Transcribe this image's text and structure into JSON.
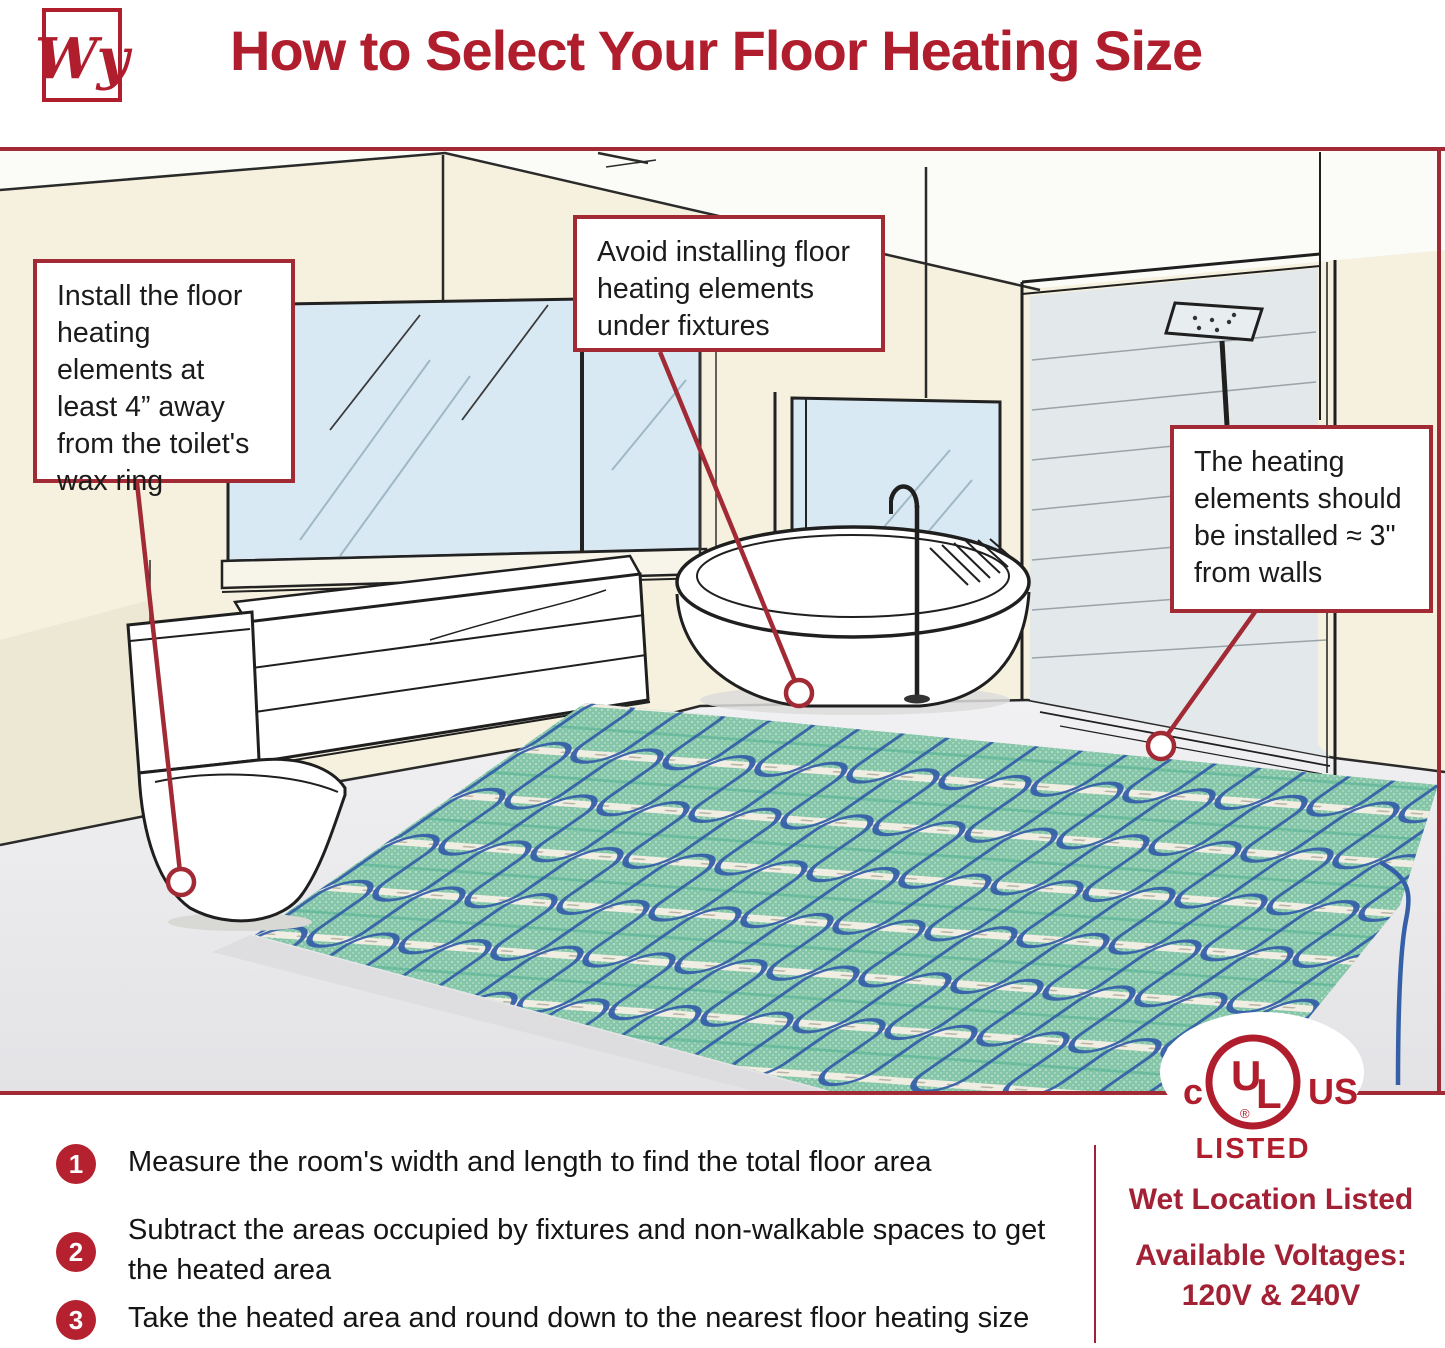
{
  "page": {
    "width": 1445,
    "height": 1348
  },
  "colors": {
    "brand_red": "#B01E2E",
    "accent_red": "#A22A35",
    "step_circle_red": "#B5212E",
    "text_black": "#1B1B1B",
    "wall_beige": "#F5F1DE",
    "window_blue": "#D9E9F3",
    "floor_gray": "#EAEAEC",
    "mat_green": "#85C5A8",
    "cable_blue": "#3560A8"
  },
  "header": {
    "logo_text": "Wy",
    "title": "How to Select Your Floor Heating Size"
  },
  "callouts": {
    "toilet": "Install the floor heating elements at least 4” away from the toilet's wax ring",
    "fixtures": "Avoid installing floor heating elements under fixtures",
    "walls": "The heating elements should be installed ≈ 3\" from walls"
  },
  "steps": [
    {
      "number": "1",
      "text": "Measure the room's width and length to find the total floor area"
    },
    {
      "number": "2",
      "text": "Subtract the areas occupied by fixtures and non-walkable spaces to get the heated area"
    },
    {
      "number": "3",
      "text": "Take the heated area and round down to the nearest floor heating size"
    }
  ],
  "certification": {
    "ul_left": "c",
    "ul_u": "U",
    "ul_l": "L",
    "ul_registered": "®",
    "ul_right": "US",
    "listed": "LISTED",
    "wet_location": "Wet Location Listed",
    "voltages_label": "Available Voltages:",
    "voltages_value": "120V & 240V"
  }
}
